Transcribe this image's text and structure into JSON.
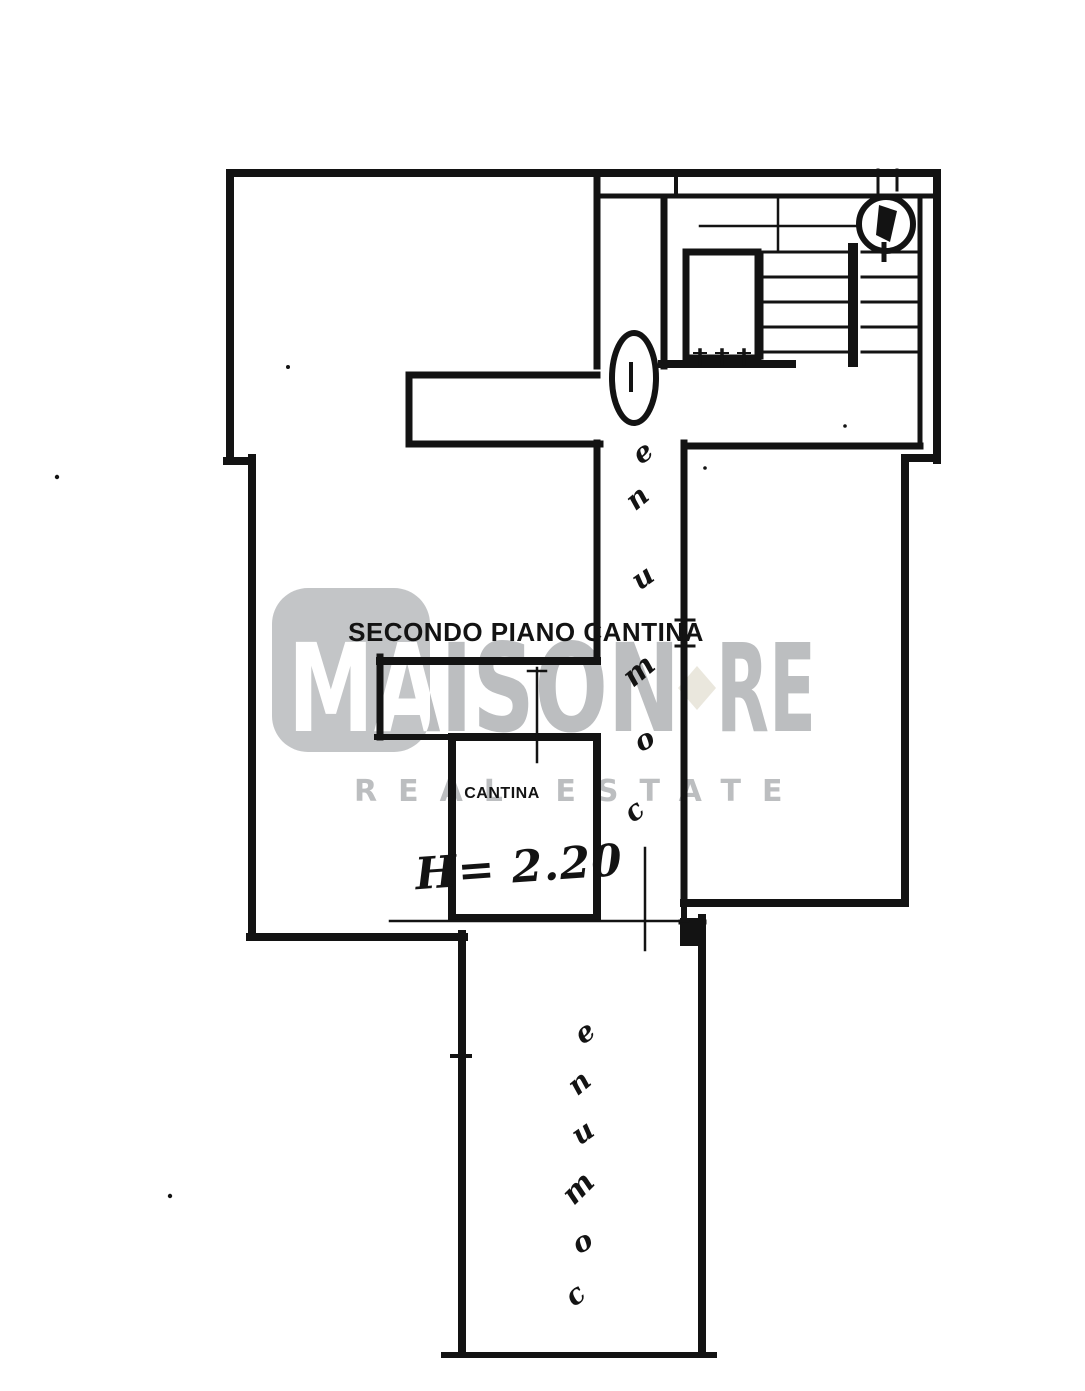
{
  "page": {
    "background_color": "#ffffff",
    "ink_color": "#131313"
  },
  "floorplan": {
    "title": "SECONDO PIANO CANTINA",
    "room": {
      "label": "CANTINA",
      "height_annotation": "H= 2.20"
    },
    "corridor_upper": {
      "word": "comune",
      "letters_top_to_bottom": [
        "e",
        "n",
        "u",
        "m",
        "o",
        "c"
      ]
    },
    "corridor_lower": {
      "word": "comune",
      "letters_top_to_bottom": [
        "e",
        "n",
        "u",
        "m",
        "o",
        "c"
      ]
    }
  },
  "watermark": {
    "brand_main": "MAISON",
    "brand_suffix": "RE",
    "tagline": "REAL ESTATE",
    "text_color": "#bcbec0",
    "logo_square_color": "#c3c5c7",
    "diamond_icon_color": "#eae7dd"
  }
}
